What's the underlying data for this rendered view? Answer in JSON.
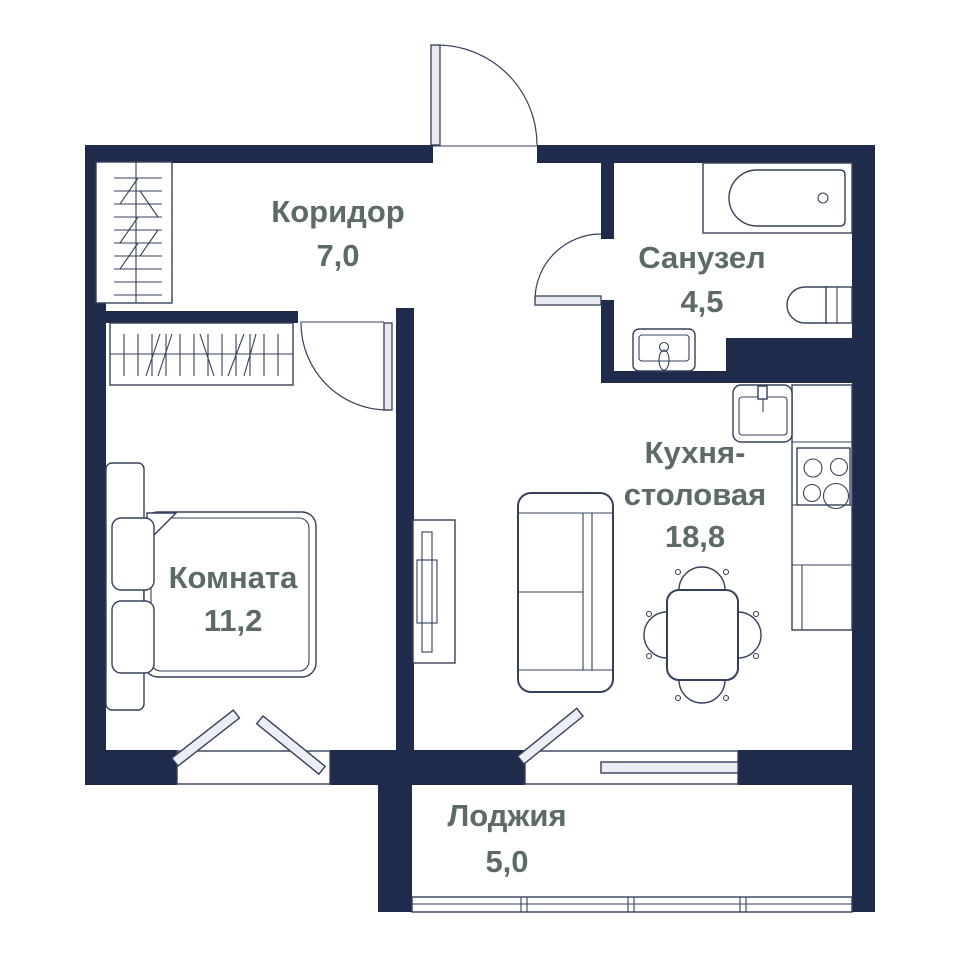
{
  "plan_title": "apartment-floor-plan",
  "rooms": {
    "corridor": {
      "name": "Коридор",
      "area": "7,0"
    },
    "bathroom": {
      "name": "Санузел",
      "area": "4,5"
    },
    "kitchen": {
      "name_line1": "Кухня-",
      "name_line2": "столовая",
      "area": "18,8"
    },
    "bedroom": {
      "name": "Комната",
      "area": "11,2"
    },
    "loggia": {
      "name": "Лоджия",
      "area": "5,0"
    }
  },
  "fixtures": [
    "entrance-door",
    "bathroom-door",
    "bedroom-door",
    "corridor-wardrobe",
    "bedroom-wardrobe",
    "bathtub",
    "toilet",
    "bathroom-sink",
    "kitchen-sink",
    "kitchen-counter",
    "stove",
    "dining-table",
    "chairs",
    "sofa",
    "tv-stand",
    "bed",
    "bedroom-window",
    "balcony-door",
    "loggia-glazing"
  ],
  "colors": {
    "bg": "#ffffff",
    "wall": "#1e2b4a",
    "line": "#35405c",
    "label": "#5c6b67",
    "casement": "#eceef3",
    "leaf": "#e8e9ee"
  }
}
